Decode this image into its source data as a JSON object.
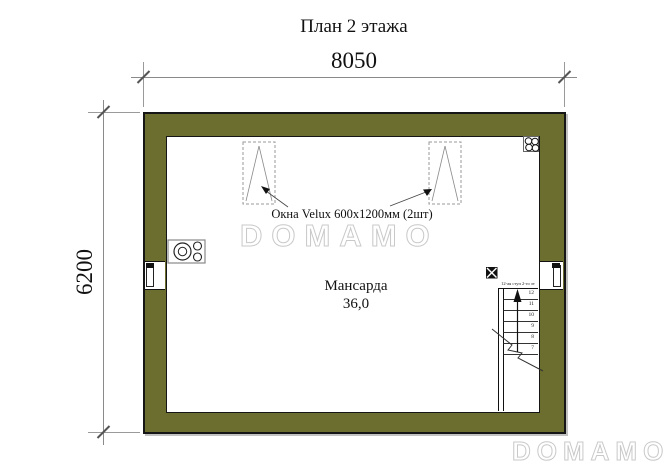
{
  "title": "План 2 этажа",
  "dimensions": {
    "width_label": "8050",
    "height_label": "6200"
  },
  "room": {
    "name": "Мансарда",
    "area": "36,0"
  },
  "annotations": {
    "velux_note": "Окна Velux 600х1200мм (2шт)",
    "stair_note": "12-ая ступ 2-го эт"
  },
  "stairs": {
    "steps": [
      "12",
      "11",
      "10",
      "9",
      "8",
      "7"
    ]
  },
  "watermark": {
    "center": "DOMAMO",
    "bottom": "DOMAMO"
  },
  "icons": {
    "stove": "stove-icon",
    "flue_block": "flue-block-icon",
    "vent_shaft": "vent-shaft-icon",
    "velux_window": "velux-roof-window-icon",
    "stair_arrow": "stairs-up-arrow-icon"
  },
  "colors": {
    "wall": "#6b6e2e",
    "outline": "#161616",
    "dimension_line": "#8a8a8a",
    "watermark_outline": "#c9c9c9"
  }
}
